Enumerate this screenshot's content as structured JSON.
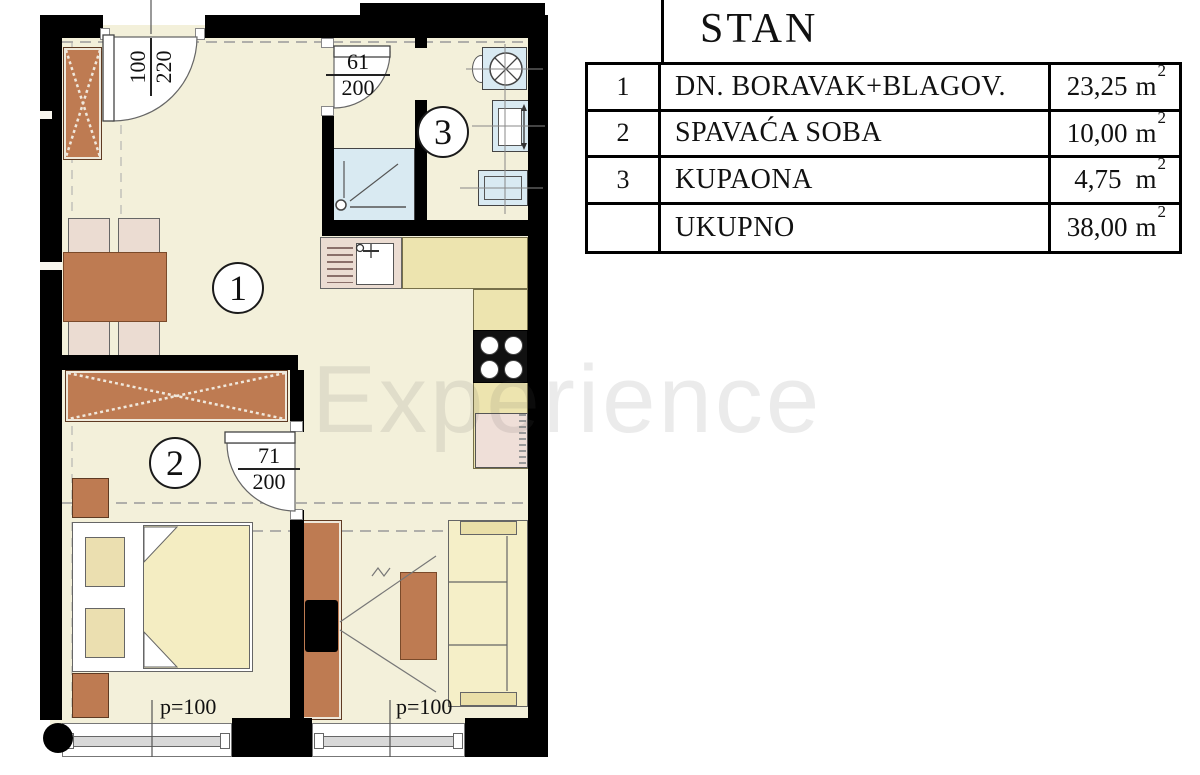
{
  "floorplan": {
    "watermark": "Experience",
    "rooms": [
      {
        "number": "1"
      },
      {
        "number": "2"
      },
      {
        "number": "3"
      }
    ],
    "doors": {
      "entrance": {
        "width": "100",
        "height": "220"
      },
      "bathroom": {
        "width": "61",
        "height": "200"
      },
      "bedroom": {
        "width": "71",
        "height": "200"
      }
    },
    "windows": {
      "bedroom_parapet": "p=100",
      "living_parapet": "p=100"
    }
  },
  "legend": {
    "title": "STAN",
    "rows": [
      {
        "num": "1",
        "name": "DN. BORAVAK+BLAGOV.",
        "area": "23,25",
        "unit": "m",
        "sup": "2"
      },
      {
        "num": "2",
        "name": "SPAVAĆA SOBA",
        "area": "10,00",
        "unit": "m",
        "sup": "2"
      },
      {
        "num": "3",
        "name": "KUPAONA",
        "area": "4,75",
        "unit": "m",
        "sup": "2"
      },
      {
        "num": "",
        "name": "UKUPNO",
        "area": "38,00",
        "unit": "m",
        "sup": "2"
      }
    ]
  },
  "colors": {
    "wall": "#000000",
    "floor": "#F3F0DA",
    "wood": "#BE7B52",
    "upholstery": "#EBDCD2",
    "counter": "#EDE4AF",
    "fixture_blue": "#D9EAF2",
    "bedding": "#F4EDC2"
  }
}
